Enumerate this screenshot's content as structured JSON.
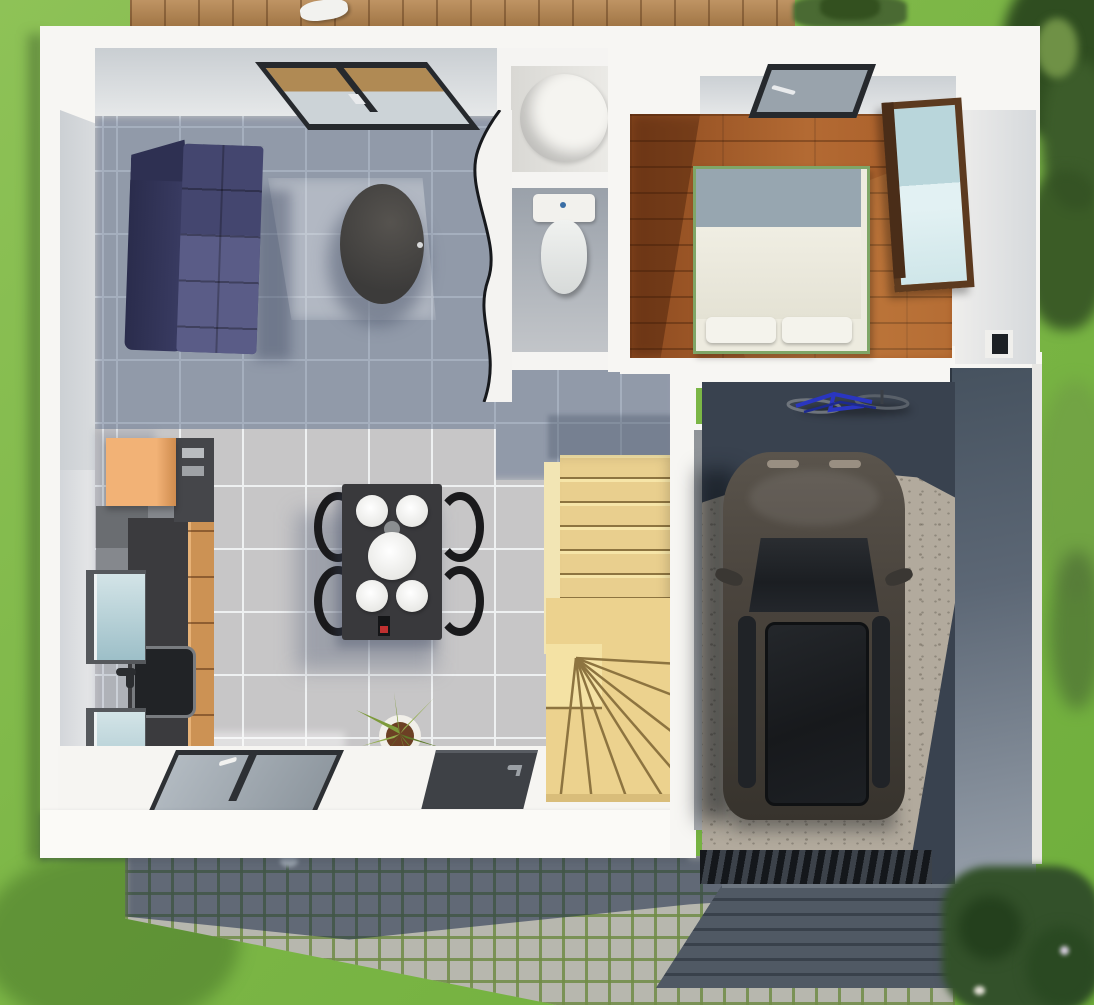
{
  "meta": {
    "type": "3d-floorplan-render",
    "view": "top-down cutaway of single-storey house with garage, garden and driveway",
    "description": "Rendered top view floor plan: open living/dining/kitchen, bathroom with shower and WC, bedroom with wood floor, winder staircase, garage with parked car and bicycles, cobblestone driveway and lawn"
  },
  "palette": {
    "grass": "#7db747",
    "tree_dark": "#2f4d20",
    "bush": "#4a6a33",
    "deck_wood": "#b6854e",
    "wall_white": "#f7f6f3",
    "wall_inner_face": "#cfd3d7",
    "tile_lit": "#c7c6c7",
    "tile_grout": "#eef0f1",
    "tile_shadow": "#62738f",
    "bedroom_wood": "#a55b28",
    "stairs_wood": "#e9cf8e",
    "concrete_lit": "#b2aa9d",
    "concrete_shadow": "#39424f",
    "slate_roof": "#46505b",
    "cobble_lit": "#b7b7ae",
    "cobble_moss": "#708c46",
    "cobble_shadow": "#2c3c5c",
    "sofa_dark": "#2e3052",
    "sofa_light": "#5a5c87",
    "coffee_table": "#474645",
    "dining_table": "#39393c",
    "chair_black": "#1a1a1c",
    "kitchen_wood": "#cc9254",
    "kitchen_counter": "#3b3b3e",
    "kitchen_accent_orange": "#f0ad6d",
    "cabinet_glass": "#c2dbe0",
    "mirror_glass": "#b9d6db",
    "wardrobe_wood": "#5c3a1f",
    "car_body": "#4a443d",
    "car_glass": "#1c1f23",
    "bike_blue": "#2a36c0",
    "window_frame": "#2b2e33",
    "door_leaf": "#3e4146",
    "bed_linen": "#edebdf",
    "bed_frame_green": "#7fa667"
  },
  "scene": {
    "exterior": {
      "garden": [
        "lawn",
        "trees-top-right",
        "hedge-bottom-right",
        "wood-deck-top",
        "bushes-top"
      ],
      "driveway": "cobblestone path with house shadow",
      "garage_roof": "dark slate tile pitched roof over garage entrance"
    },
    "rooms": [
      {
        "name": "living-room",
        "floor": "grey ceramic tile",
        "furniture": [
          "corner-sofa (navy two-tone)",
          "oval-coffee-table (dark)",
          "roof-window (dark frame)"
        ]
      },
      {
        "name": "dining-area",
        "floor": "grey ceramic tile",
        "furniture": [
          "dark dining table",
          "4 white plates",
          "white serving bowl",
          "wine bottle",
          "4 black chairs",
          "potted plant"
        ]
      },
      {
        "name": "kitchen",
        "floor": "grey ceramic tile",
        "furniture": [
          "orange wall box cabinet",
          "tall oven column",
          "dark worktop with sink and faucet",
          "fridge/appliance block",
          "2 glass-front wall cabinets",
          "wood drawer fronts"
        ]
      },
      {
        "name": "bathroom",
        "floor": "grey tile",
        "furniture": [
          "round shower tray",
          "toilet with cistern",
          "curved partition wall"
        ]
      },
      {
        "name": "bedroom",
        "floor": "oak plank",
        "furniture": [
          "double bed with white duvet and 2 pillows",
          "wardrobe with mirror door",
          "roof-window",
          "small wall niche"
        ]
      },
      {
        "name": "hallway-stairs",
        "floor": "grey tile",
        "furniture": [
          "winder staircase in light wood",
          "threshold step to garage"
        ]
      },
      {
        "name": "garage",
        "floor": "concrete",
        "furniture": [
          "parked car (dark grey, sunroof)",
          "two bicycles (blue)",
          "sectional garage door slats"
        ]
      }
    ],
    "openings": [
      "bottom wall: 2-pane window with handle",
      "bottom wall: dark entrance door with handle",
      "living room skylight",
      "bedroom skylight",
      "bedroom side niche window"
    ]
  }
}
